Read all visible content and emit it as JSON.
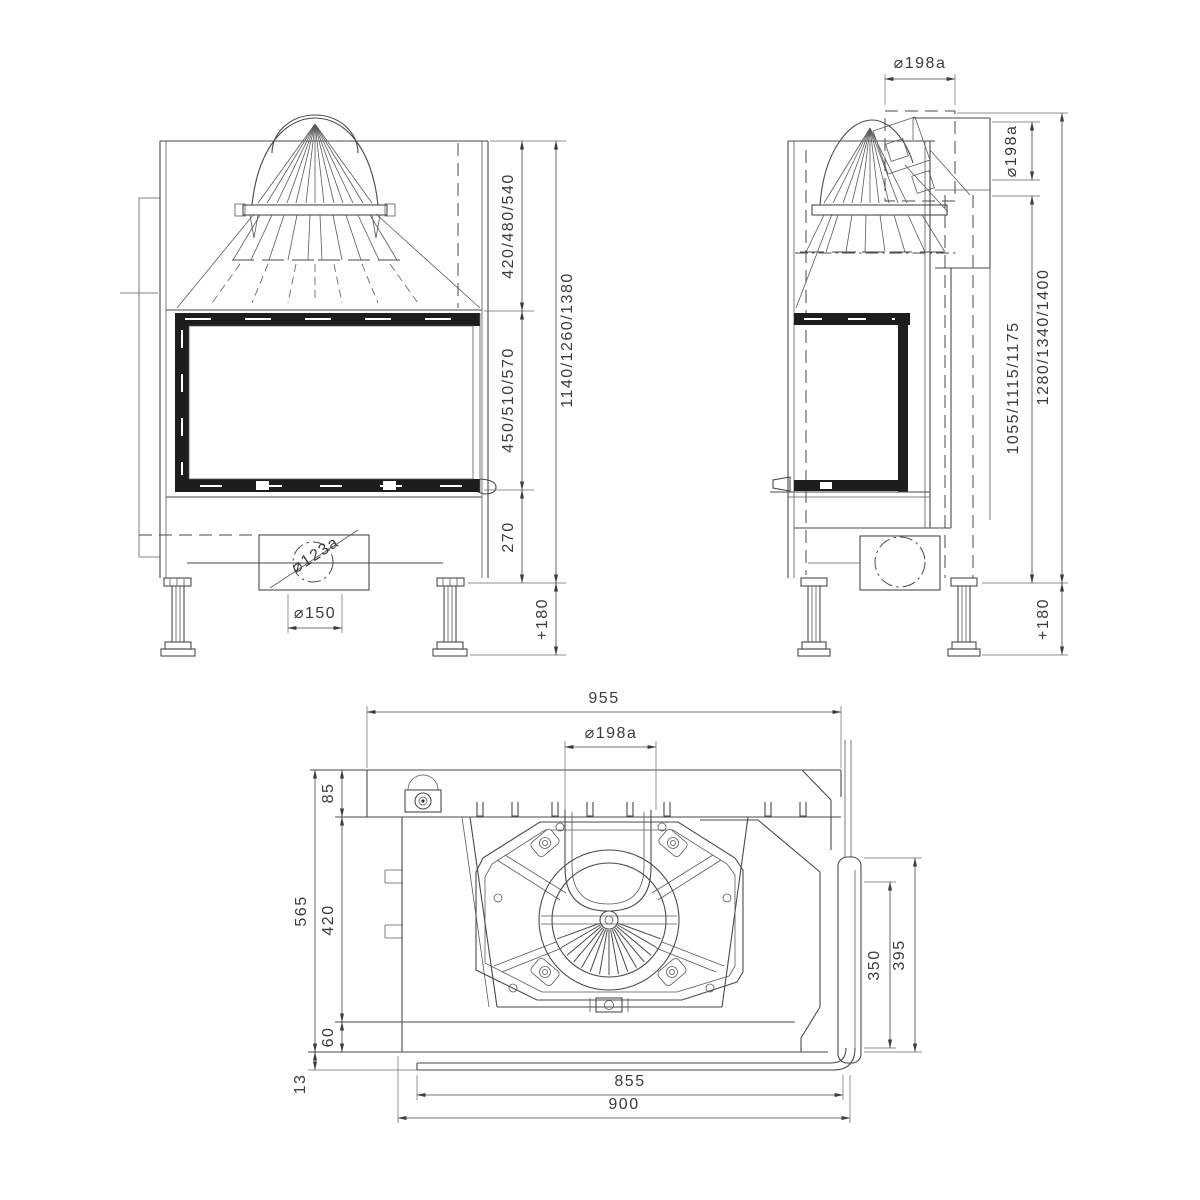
{
  "meta": {
    "title": "Fireplace insert technical drawing, three orthographic views",
    "background": "#ffffff",
    "line_color": "#4a4a4a",
    "text_color": "#3b3b3b"
  },
  "views": {
    "front": {
      "name": "front-view",
      "dims": {
        "hood_height": "420/480/540",
        "window_height": "450/510/570",
        "base_height": "270",
        "total_height": "1140/1260/1380",
        "legs": "+180",
        "air_spigot": "⌀123a",
        "air_duct": "⌀150"
      }
    },
    "side": {
      "name": "side-view",
      "dims": {
        "flue_top": "⌀198a",
        "flue_rear": "⌀198a",
        "rear_outlet_height": "1055/1115/1175",
        "total_height": "1280/1340/1400",
        "legs": "+180"
      }
    },
    "plan": {
      "name": "top-view",
      "dims": {
        "overall_width": "955",
        "flue": "⌀198a",
        "rear_depth": "85",
        "chamber_depth": "420",
        "front_depth": "60",
        "overall_depth": "565",
        "glass_offset": "13",
        "side_glass_inner": "350",
        "side_glass_outer": "395",
        "glass_width": "855",
        "front_width": "900"
      }
    }
  }
}
